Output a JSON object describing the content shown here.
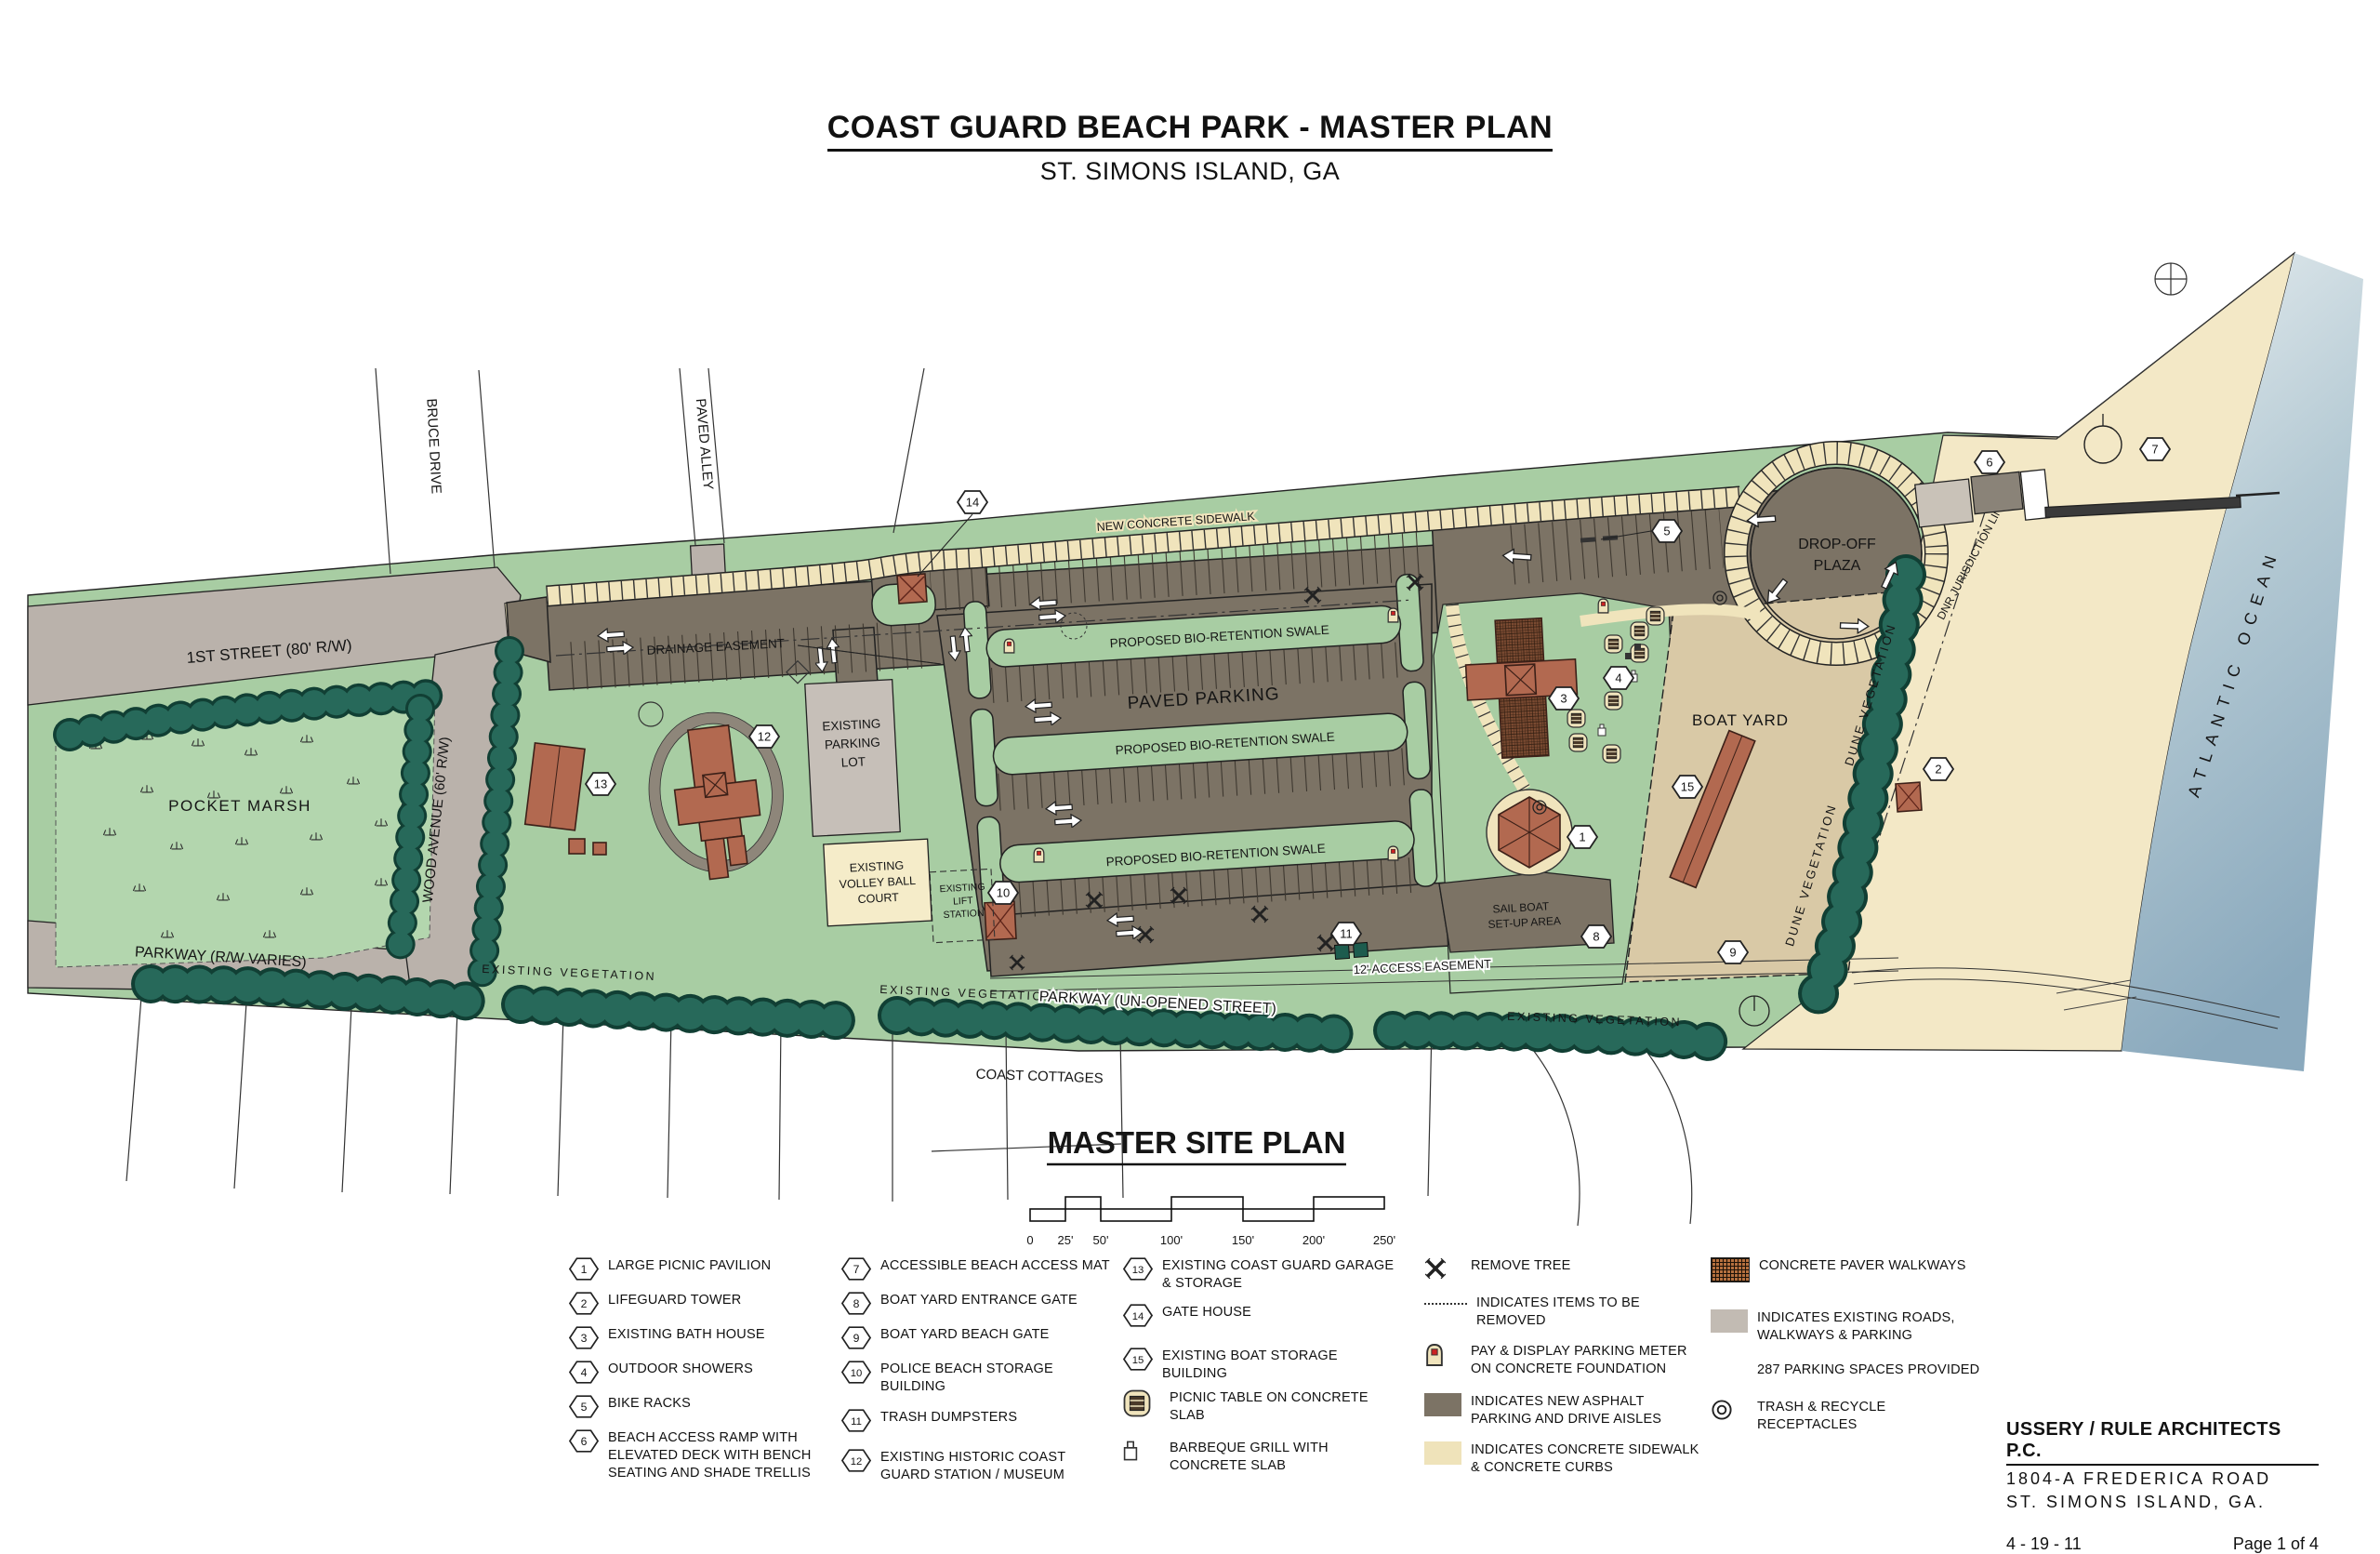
{
  "title": {
    "main": "COAST GUARD BEACH PARK - MASTER PLAN",
    "sub": "ST. SIMONS ISLAND, GA"
  },
  "map": {
    "labels": {
      "first_street": "1ST STREET (80' R/W)",
      "bruce_drive": "BRUCE DRIVE",
      "paved_alley": "PAVED ALLEY",
      "pocket_marsh": "POCKET MARSH",
      "wood_avenue": "WOOD AVENUE (60' R/W)",
      "parkway_rw": "PARKWAY (R/W VARIES)",
      "drainage_easement": "DRAINAGE EASEMENT",
      "parking_lot": [
        "EXISTING",
        "PARKING",
        "LOT"
      ],
      "volley": [
        "EXISTING",
        "VOLLEY BALL",
        "COURT"
      ],
      "paved_parking": "PAVED PARKING",
      "swale": "PROPOSED BIO-RETENTION SWALE",
      "sidewalk": "NEW CONCRETE SIDEWALK",
      "dropoff": [
        "DROP-OFF",
        "PLAZA"
      ],
      "boat_yard": "BOAT YARD",
      "dune_veg": "DUNE VEGETATION",
      "dnr": "DNR JURISDICTION LINE",
      "ocean": "ATLANTIC OCEAN",
      "lift": [
        "EXISTING",
        "LIFT",
        "STATION"
      ],
      "sailboat": [
        "SAIL BOAT",
        "SET-UP AREA"
      ],
      "access_easement": "12' ACCESS EASEMENT",
      "existing_veg": "EXISTING VEGETATION",
      "parkway_unopened": "PARKWAY (UN-OPENED STREET)",
      "coast_cottages": "COAST COTTAGES"
    },
    "badges": [
      "1",
      "2",
      "3",
      "4",
      "5",
      "6",
      "7",
      "8",
      "9",
      "10",
      "11",
      "12",
      "13",
      "14",
      "15"
    ],
    "colors": {
      "grass_green": "#a8cda3",
      "marsh_green": "#b3d6ae",
      "tree_green": "#27695a",
      "new_asphalt": "#7c7365",
      "existing_road": "#bab2ab",
      "existing_lot": "#c6bfb8",
      "concrete_cream": "#f0e4bc",
      "sand": "#f3e8c6",
      "ocean_blue": "#8fb0c3",
      "boat_yard_tan": "#d9c9a6",
      "building_red": "#b26950",
      "paver_brown": "#7a4a31",
      "remove_red": "#cc2222"
    }
  },
  "site_plan": {
    "title": "MASTER SITE PLAN",
    "scale_ticks": [
      "0",
      "25'",
      "50'",
      "100'",
      "150'",
      "200'",
      "250'"
    ]
  },
  "legend": {
    "col1": [
      {
        "num": "1",
        "label": "LARGE PICNIC PAVILION"
      },
      {
        "num": "2",
        "label": "LIFEGUARD TOWER"
      },
      {
        "num": "3",
        "label": "EXISTING BATH HOUSE"
      },
      {
        "num": "4",
        "label": "OUTDOOR SHOWERS"
      },
      {
        "num": "5",
        "label": "BIKE RACKS"
      },
      {
        "num": "6",
        "label": "BEACH ACCESS RAMP WITH\nELEVATED DECK WITH BENCH\nSEATING AND SHADE TRELLIS"
      }
    ],
    "col2": [
      {
        "num": "7",
        "label": "ACCESSIBLE BEACH ACCESS MAT"
      },
      {
        "num": "8",
        "label": "BOAT YARD ENTRANCE GATE"
      },
      {
        "num": "9",
        "label": "BOAT YARD BEACH GATE"
      },
      {
        "num": "10",
        "label": "POLICE BEACH STORAGE\nBUILDING"
      },
      {
        "num": "11",
        "label": "TRASH DUMPSTERS"
      },
      {
        "num": "12",
        "label": "EXISTING HISTORIC COAST\nGUARD STATION / MUSEUM"
      }
    ],
    "col3": [
      {
        "num": "13",
        "label": "EXISTING COAST GUARD GARAGE\n& STORAGE"
      },
      {
        "num": "14",
        "label": "GATE HOUSE"
      },
      {
        "num": "15",
        "label": "EXISTING BOAT STORAGE\nBUILDING"
      },
      {
        "icon": "picnic-table",
        "label": "PICNIC TABLE ON CONCRETE\nSLAB"
      },
      {
        "icon": "barbeque-grill",
        "label": "BARBEQUE GRILL WITH\nCONCRETE SLAB"
      }
    ],
    "col4": [
      {
        "icon": "remove-tree-x",
        "label": "REMOVE TREE"
      },
      {
        "icon": "dotted-line",
        "label": "INDICATES ITEMS TO BE\nREMOVED"
      },
      {
        "icon": "parking-meter",
        "label": "PAY & DISPLAY PARKING METER\nON CONCRETE FOUNDATION"
      },
      {
        "icon": "swatch-asphalt",
        "label": "INDICATES NEW ASPHALT\nPARKING AND DRIVE AISLES"
      },
      {
        "icon": "swatch-concrete",
        "label": "INDICATES CONCRETE SIDEWALK\n& CONCRETE CURBS"
      }
    ],
    "col5": [
      {
        "icon": "swatch-paver",
        "label": "CONCRETE PAVER WALKWAYS"
      },
      {
        "icon": "swatch-existing-road",
        "label": "INDICATES EXISTING ROADS,\nWALKWAYS & PARKING"
      },
      {
        "icon": "none",
        "label": "287 PARKING SPACES PROVIDED"
      },
      {
        "icon": "trash-recycle",
        "label": "TRASH & RECYCLE\nRECEPTACLES"
      }
    ]
  },
  "footer": {
    "firm": "USSERY / RULE ARCHITECTS P.C.",
    "address1": "1804-A FREDERICA ROAD",
    "address2": "ST. SIMONS ISLAND, GA.",
    "date": "4 - 19 - 11",
    "page": "Page 1 of 4"
  }
}
